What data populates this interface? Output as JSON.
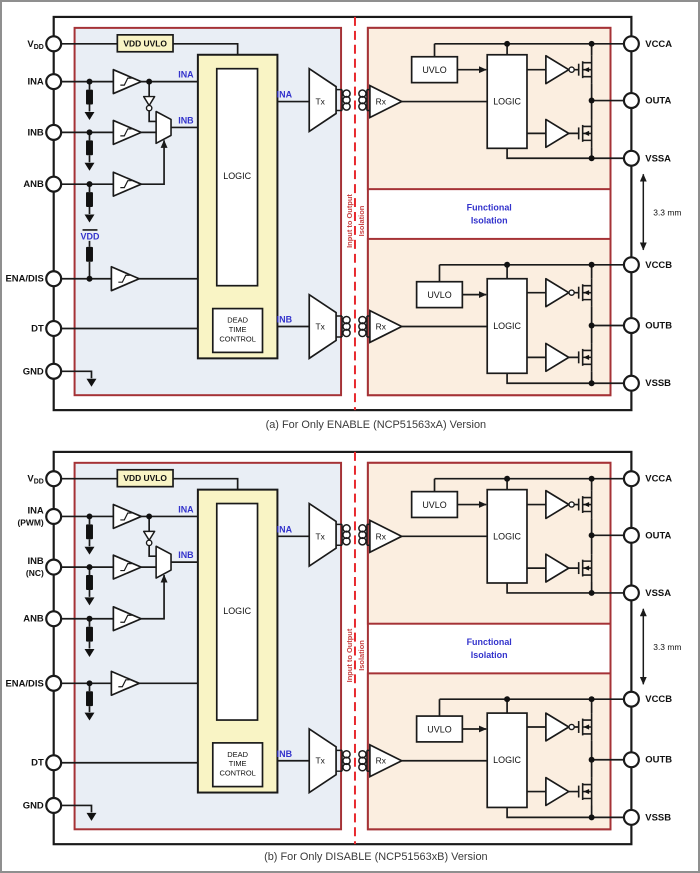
{
  "colors": {
    "region_left_fill": "#e9eef5",
    "region_right_fill": "#fbeee0",
    "logic_region_fill": "#f9f4c5",
    "isolation_border_red": "#a53236",
    "isolation_dashed_red": "#e8282d",
    "signal_label_blue": "#3333cc",
    "isolation_label_red": "#c94040",
    "line_black": "#1a1a1a"
  },
  "diagram_a": {
    "caption": "(a) For Only ENABLE (NCP51563xA) Version",
    "pins_left": {
      "vdd_v": "V",
      "vdd_dd": "DD",
      "ina": "INA",
      "inb": "INB",
      "anb": "ANB",
      "ena_dis": "ENA/DIS",
      "dt": "DT",
      "gnd": "GND"
    },
    "pins_right": {
      "vcca": "VCCA",
      "outa": "OUTA",
      "vssa": "VSSA",
      "vccb": "VCCB",
      "outb": "OUTB",
      "vssb": "VSSB"
    },
    "blocks": {
      "vdd_uvlo": "VDD UVLO",
      "logic_input": "LOGIC",
      "dead_line1": "DEAD",
      "dead_line2": "TIME",
      "dead_line3": "CONTROL",
      "tx_a": "Tx",
      "rx_a": "Rx",
      "uvlo_a": "UVLO",
      "logic_a": "LOGIC",
      "tx_b": "Tx",
      "rx_b": "Rx",
      "uvlo_b": "UVLO",
      "logic_b": "LOGIC"
    },
    "signals": {
      "ina_logic": "INA",
      "inb_logic": "INB",
      "ina_tx": "INA",
      "inb_tx": "INB",
      "vdd_pullup": "VDD"
    },
    "isolation_text": {
      "line1": "Input to Output",
      "line2": "Isolation"
    },
    "functional_text": {
      "line1": "Functional",
      "line2": "Isolation"
    },
    "dimension_label": "3.3 mm"
  },
  "diagram_b": {
    "caption": "(b) For Only DISABLE (NCP51563xB) Version",
    "pins_left": {
      "vdd_v": "V",
      "vdd_dd": "DD",
      "ina": "INA",
      "ina_sub": "(PWM)",
      "inb": "INB",
      "inb_sub": "(NC)",
      "anb": "ANB",
      "ena_dis": "ENA/DIS",
      "dt": "DT",
      "gnd": "GND"
    },
    "pins_right": {
      "vcca": "VCCA",
      "outa": "OUTA",
      "vssa": "VSSA",
      "vccb": "VCCB",
      "outb": "OUTB",
      "vssb": "VSSB"
    },
    "blocks": {
      "vdd_uvlo": "VDD UVLO",
      "logic_input": "LOGIC",
      "dead_line1": "DEAD",
      "dead_line2": "TIME",
      "dead_line3": "CONTROL",
      "tx_a": "Tx",
      "rx_a": "Rx",
      "uvlo_a": "UVLO",
      "logic_a": "LOGIC",
      "tx_b": "Tx",
      "rx_b": "Rx",
      "uvlo_b": "UVLO",
      "logic_b": "LOGIC"
    },
    "signals": {
      "ina_logic": "INA",
      "inb_logic": "INB",
      "ina_tx": "INA",
      "inb_tx": "INB"
    },
    "isolation_text": {
      "line1": "Input to Output",
      "line2": "Isolation"
    },
    "functional_text": {
      "line1": "Functional",
      "line2": "Isolation"
    },
    "dimension_label": "3.3 mm"
  }
}
